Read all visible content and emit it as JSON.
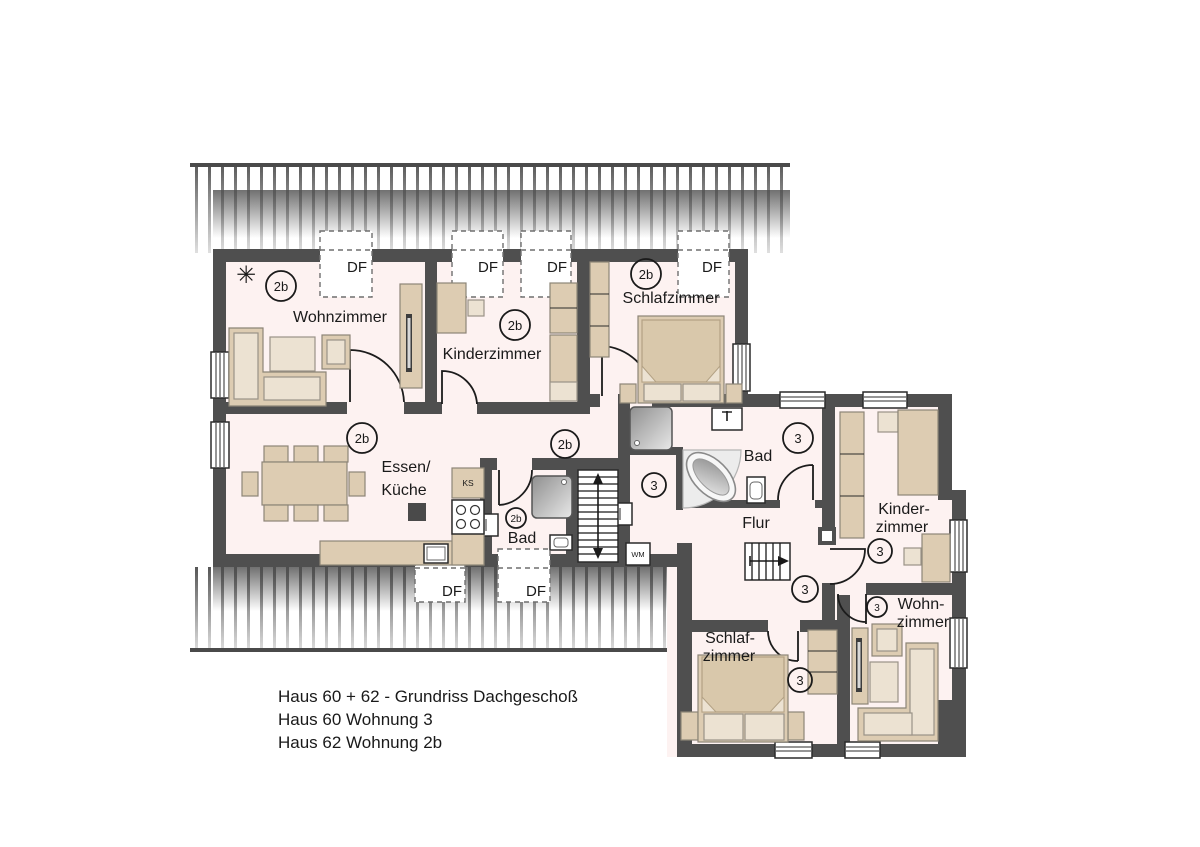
{
  "floorplan": {
    "dormer": "DF",
    "icons": {
      "plant": "✳"
    },
    "apartment_2b": {
      "unit": "2b",
      "rooms": {
        "wohnzimmer": "Wohnzimmer",
        "kinderzimmer": "Kinderzimmer",
        "schlafzimmer": "Schlafzimmer",
        "essen_line1": "Essen/",
        "essen_line2": "Küche",
        "bad": "Bad"
      },
      "appliances": {
        "ks": "KS"
      }
    },
    "apartment_3": {
      "unit": "3",
      "rooms": {
        "bad": "Bad",
        "flur": "Flur",
        "kinder_line1": "Kinder-",
        "kinder_line2": "zimmer",
        "wohn_line1": "Wohn-",
        "wohn_line2": "zimmer",
        "schlaf_line1": "Schlaf-",
        "schlaf_line2": "zimmer"
      },
      "appliances": {
        "wm": "WM"
      }
    }
  },
  "title_block": {
    "line1": "Haus 60 + 62 - Grundriss Dachgeschoß",
    "line2": "Haus 60 Wohnung 3",
    "line3": "Haus 62 Wohnung 2b"
  },
  "colors": {
    "wall": "#4f4f4f",
    "floor": "#fdf2f1",
    "furniture": "#ddccb2",
    "roof_hatch": "#4a4a4a",
    "plant": "#3f7d1d"
  }
}
